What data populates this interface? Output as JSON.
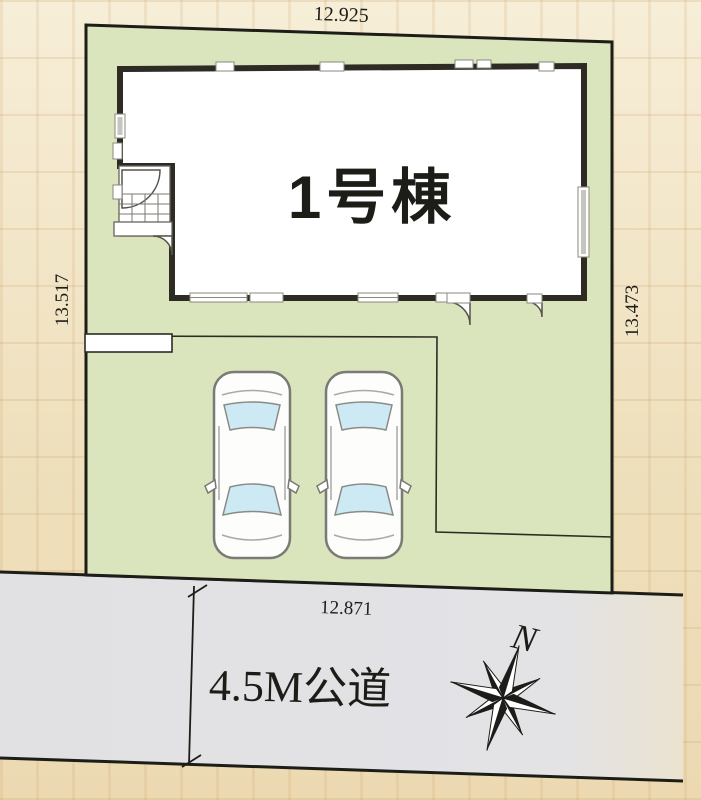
{
  "plan": {
    "building": {
      "label": "1号棟"
    },
    "dimensions": {
      "top": "12.925",
      "left": "13.517",
      "right": "13.473",
      "frontage": "12.871"
    },
    "road": {
      "label": "4.5M公道"
    },
    "compass": {
      "north": "N"
    },
    "vehicles": {
      "count": 2
    },
    "colors": {
      "lot_fill": "#dbe5bd",
      "road_fill": "#e2e2e5",
      "wall": "#2d2b24",
      "background": "#f1e3c3",
      "glass": "#cde9f4"
    }
  }
}
